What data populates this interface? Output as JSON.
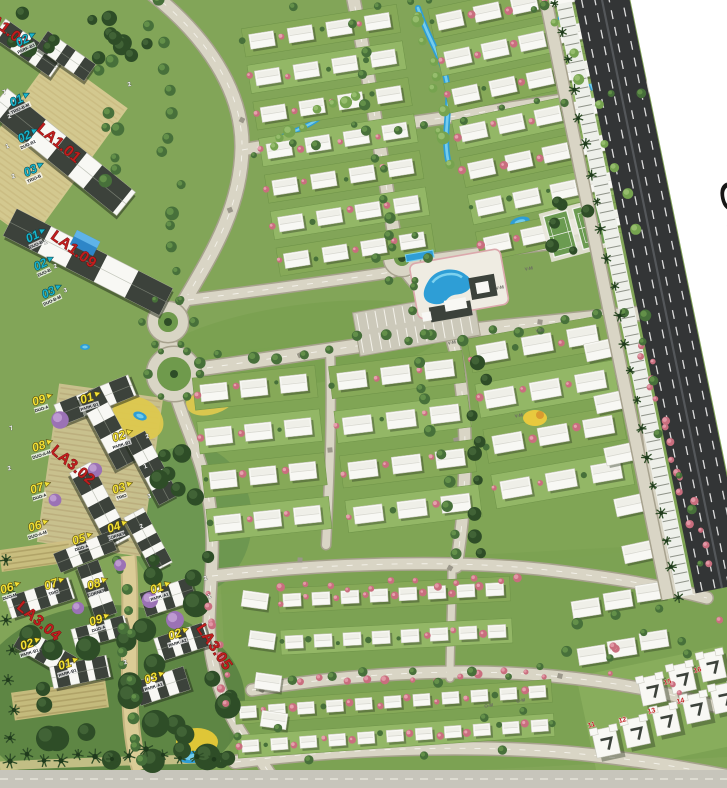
{
  "meta": {
    "kind": "residential-masterplan-map",
    "width": 727,
    "height": 788
  },
  "map": {
    "offsite_label": {
      "text": "Sec",
      "truncated": true,
      "color": "#161616"
    },
    "zone_labels": [
      {
        "text": "LA1.02",
        "x": -18,
        "y": 16,
        "rot": 38
      },
      {
        "text": "LA1.01",
        "x": 36,
        "y": 130,
        "rot": 40
      },
      {
        "text": "LA1.09",
        "x": 50,
        "y": 238,
        "rot": 36
      },
      {
        "text": "LA3.02",
        "x": 50,
        "y": 452,
        "rot": 40
      },
      {
        "text": "LA3.04",
        "x": 16,
        "y": 608,
        "rot": 40
      },
      {
        "text": "LA3.05",
        "x": 196,
        "y": 628,
        "rot": 56
      }
    ],
    "cyan_markers": [
      {
        "num": "02",
        "label": "PARK-B1",
        "x": 24,
        "y": 44,
        "rot": -25
      },
      {
        "num": "01",
        "label": "TRIO-B-M",
        "x": 18,
        "y": 104,
        "rot": -25
      },
      {
        "num": "02",
        "label": "DUO-B1",
        "x": 26,
        "y": 140,
        "rot": -25
      },
      {
        "num": "03",
        "label": "TRIO-B",
        "x": 32,
        "y": 174,
        "rot": -25
      },
      {
        "num": "01",
        "label": "DUO-B",
        "x": 34,
        "y": 240,
        "rot": -25
      },
      {
        "num": "02",
        "label": "DUO-B",
        "x": 42,
        "y": 268,
        "rot": -25
      },
      {
        "num": "03",
        "label": "DUO-B-M",
        "x": 50,
        "y": 296,
        "rot": -25
      }
    ],
    "yellow_markers": [
      {
        "num": "09",
        "label": "DUO-A",
        "x": 40,
        "y": 404,
        "rot": -18
      },
      {
        "num": "01",
        "label": "PARK-B1",
        "x": 88,
        "y": 402,
        "rot": -18
      },
      {
        "num": "08",
        "label": "DUO-A-M",
        "x": 40,
        "y": 450,
        "rot": -18
      },
      {
        "num": "02",
        "label": "PARK-B1",
        "x": 120,
        "y": 440,
        "rot": -18
      },
      {
        "num": "07",
        "label": "DUO-A",
        "x": 38,
        "y": 492,
        "rot": -18
      },
      {
        "num": "03",
        "label": "TRIO",
        "x": 120,
        "y": 492,
        "rot": -18
      },
      {
        "num": "06",
        "label": "DUO-A-M",
        "x": 36,
        "y": 530,
        "rot": -18
      },
      {
        "num": "04",
        "label": "CORNER",
        "x": 115,
        "y": 531,
        "rot": -18
      },
      {
        "num": "05",
        "label": "DUO-A",
        "x": 80,
        "y": 543,
        "rot": -18
      },
      {
        "num": "06",
        "label": "DUO-M",
        "x": 8,
        "y": 592,
        "rot": -18
      },
      {
        "num": "07",
        "label": "TRIO",
        "x": 52,
        "y": 588,
        "rot": -18
      },
      {
        "num": "08",
        "label": "CORNER",
        "x": 95,
        "y": 588,
        "rot": -18
      },
      {
        "num": "09",
        "label": "DUO-A",
        "x": 97,
        "y": 624,
        "rot": -18
      },
      {
        "num": "02",
        "label": "PARK-B1",
        "x": 28,
        "y": 648,
        "rot": -18
      },
      {
        "num": "01",
        "label": "PARK-B1",
        "x": 66,
        "y": 668,
        "rot": -18
      },
      {
        "num": "01",
        "label": "PARK-A1",
        "x": 158,
        "y": 592,
        "rot": -18
      },
      {
        "num": "02",
        "label": "PARK-A2",
        "x": 176,
        "y": 638,
        "rot": -18
      },
      {
        "num": "03",
        "label": "PARK-A1",
        "x": 152,
        "y": 682,
        "rot": -18
      }
    ],
    "roof_labels": [
      {
        "text": "V-M",
        "x": 500,
        "y": 289
      },
      {
        "text": "V-M",
        "x": 529,
        "y": 270
      },
      {
        "text": "V-M",
        "x": 452,
        "y": 344
      },
      {
        "text": "V-M",
        "x": 540,
        "y": 332
      },
      {
        "text": "V-M",
        "x": 519,
        "y": 417
      },
      {
        "text": "O-M",
        "x": 489,
        "y": 707
      },
      {
        "text": "O-M",
        "x": 521,
        "y": 702
      }
    ],
    "plot_numbers_red": [
      {
        "text": "11",
        "x": 592,
        "y": 727
      },
      {
        "text": "12",
        "x": 623,
        "y": 722
      },
      {
        "text": "13",
        "x": 652,
        "y": 713
      },
      {
        "text": "14",
        "x": 681,
        "y": 703
      },
      {
        "text": "15",
        "x": 668,
        "y": 684
      },
      {
        "text": "16",
        "x": 698,
        "y": 672
      }
    ],
    "plot_digits_white": [
      {
        "t": "2",
        "x": 130,
        "y": 86
      },
      {
        "t": "7",
        "x": 5,
        "y": 94
      },
      {
        "t": "2",
        "x": 10,
        "y": 118
      },
      {
        "t": "1",
        "x": 8,
        "y": 148
      },
      {
        "t": "2",
        "x": 14,
        "y": 178
      },
      {
        "t": "1",
        "x": 46,
        "y": 244
      },
      {
        "t": "2",
        "x": 56,
        "y": 268
      },
      {
        "t": "3",
        "x": 66,
        "y": 292
      },
      {
        "t": "2",
        "x": 148,
        "y": 438
      },
      {
        "t": "1",
        "x": 146,
        "y": 468
      },
      {
        "t": "3",
        "x": 150,
        "y": 498
      },
      {
        "t": "2",
        "x": 142,
        "y": 528
      },
      {
        "t": "2",
        "x": 206,
        "y": 580
      },
      {
        "t": "1",
        "x": 210,
        "y": 598
      },
      {
        "t": "2",
        "x": 126,
        "y": 664
      },
      {
        "t": "7",
        "x": 12,
        "y": 430
      },
      {
        "t": "2",
        "x": 10,
        "y": 470
      }
    ],
    "colors": {
      "base_green": "#82a558",
      "lawn_light": "#93b766",
      "lawn_mid": "#86a958",
      "park_dark": "#5c8443",
      "tree_dark": "#2e4d27",
      "tree_mid": "#47703a",
      "tree_light": "#76a34f",
      "pink_tree": "#e6a0ad",
      "pink_deep": "#c96e7e",
      "road_fill": "#d9d5c5",
      "road_edge": "#a7a28e",
      "road_dash": "#f4f2ea",
      "highway_dark": "#333536",
      "highway_lane": "#dcdcdc",
      "white_bg": "#ffffff",
      "villa_white": "#f8f8f4",
      "roof_dark": "#3c423b",
      "water": "#2e9ed6",
      "water_light": "#7dd2ef",
      "beige": "#dbcc96",
      "beige_dark": "#c9b97f",
      "label_red": "#c01e1e",
      "marker_cyan": "#1ab5cb",
      "marker_yellow": "#f2e136",
      "bottom_road": "#c7c5bb",
      "lilac": "#9b72b5"
    }
  }
}
